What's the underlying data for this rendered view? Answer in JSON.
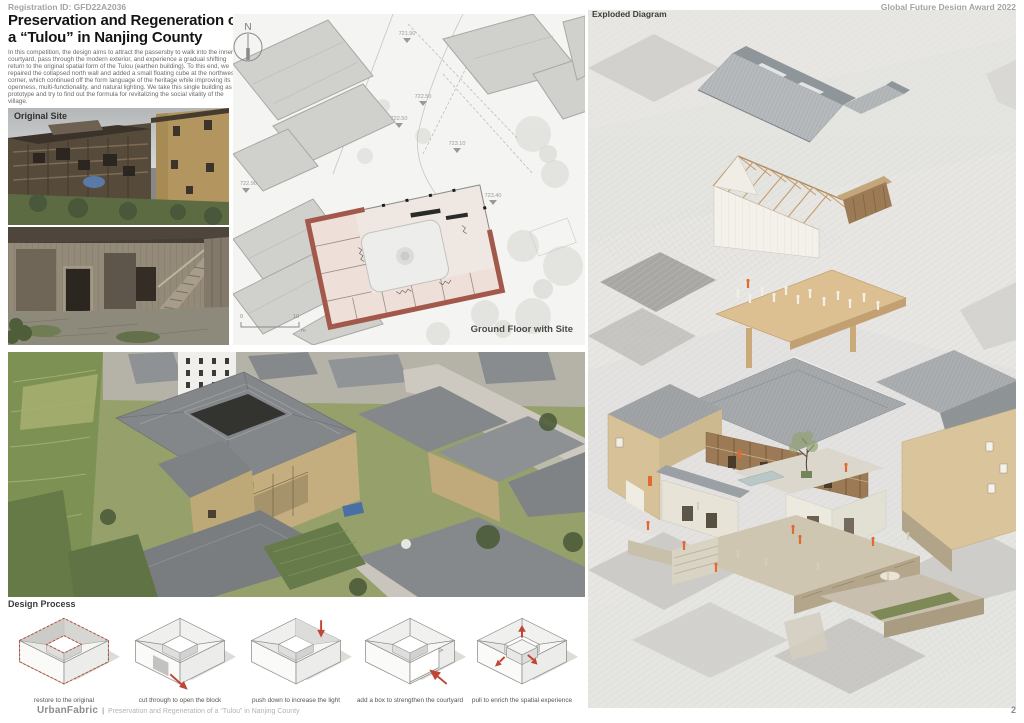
{
  "header": {
    "registration_id": "Registration ID: GFD22A2036",
    "award": "Global Future Design Award 2022"
  },
  "title": {
    "line1": "Preservation and Regeneration of",
    "line2": "a “Tulou” in Nanjing County"
  },
  "intro": "In this competition, the design aims to attract the passersby to walk into the inner courtyard, pass through the modern exterior, and experience a gradual shifting return to the original spatial form of the Tulou (earthen building). To this end, we repaired the collapsed north wall and added a small floating cube at the northwest corner, which continued off the form language of the heritage while improving its openness, multi-functionality, and natural lighting. We take this single building as a prototype and try to find out the formula for revitalizing the social vitality of the village.",
  "labels": {
    "original_site": "Original Site",
    "plan_caption": "Ground Floor with Site",
    "exploded_diagram": "Exploded Diagram",
    "design_process": "Design Process"
  },
  "plan": {
    "north": "N",
    "elevations": [
      "721.90",
      "722.50",
      "722.50",
      "723.10",
      "722.90",
      "723.40"
    ],
    "scale_start": "0",
    "scale_end": "10",
    "scale_unit": "m"
  },
  "design_process": {
    "steps": [
      {
        "caption": "restore to the original"
      },
      {
        "caption": "cut through to open the block"
      },
      {
        "caption": "push down to increase the light"
      },
      {
        "caption": "add a box to strengthen the courtyard"
      },
      {
        "caption": "pull to enrich the spatial experience"
      }
    ]
  },
  "footer": {
    "brand": "UrbanFabric",
    "separator": "|",
    "subtitle": "Preservation and Regeneration of a “Tulou” in Nanjing County",
    "page_number": "2"
  },
  "colors": {
    "plan_wall_red": "#a2584a",
    "process_arrow_red": "#bf4534",
    "people_orange": "#e06a30",
    "roof_gray": "#a6aaad",
    "earth_tan": "#d9c49c"
  }
}
